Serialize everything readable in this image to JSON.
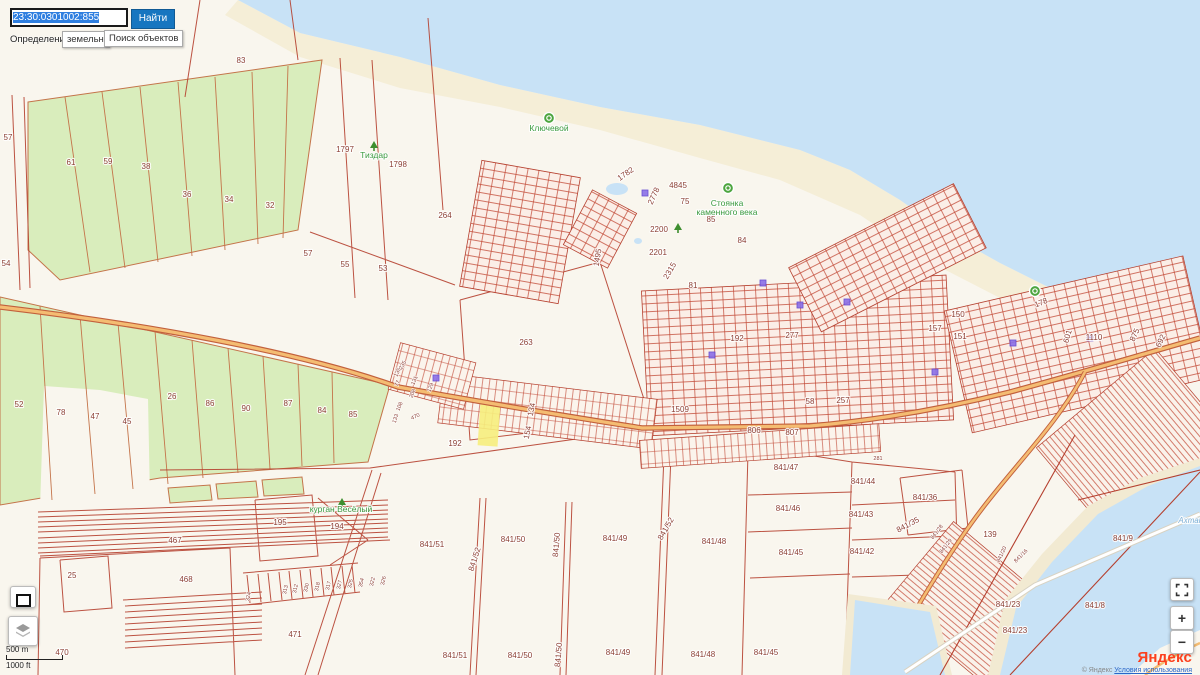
{
  "search": {
    "value": "23:30:0301002:855",
    "find_button": "Найти",
    "definition_label": "Определение:",
    "kind_chip": "земельны",
    "objects_chip": "Поиск объектов"
  },
  "scalebar": {
    "metric": "500 m",
    "imperial": "1000 ft"
  },
  "controls": {
    "zoom_in": "+",
    "zoom_out": "−"
  },
  "attribution": {
    "logo": "Яндекс",
    "copyright": "© Яндекс",
    "terms_link": "Условия использования"
  },
  "colors": {
    "accent_button": "#1676c0",
    "selection": "#2f7fe0",
    "sea": "#c8e2f6",
    "field_green": "#d9edbc",
    "parcel_red": "#c24936",
    "road_orange": "#f4bc72",
    "highlight_parcel": "#f6ee7d",
    "yandex_red": "#fc3f1d"
  },
  "map": {
    "labels": [
      {
        "t": "83",
        "x": 241,
        "y": 63
      },
      {
        "t": "1797",
        "x": 345,
        "y": 152
      },
      {
        "t": "1798",
        "x": 398,
        "y": 167
      },
      {
        "t": "264",
        "x": 445,
        "y": 218
      },
      {
        "t": "263",
        "x": 526,
        "y": 345
      },
      {
        "t": "1495",
        "x": 600,
        "y": 258,
        "r": -80,
        "s": 7
      },
      {
        "t": "55",
        "x": 345,
        "y": 267
      },
      {
        "t": "53",
        "x": 383,
        "y": 271
      },
      {
        "t": "57",
        "x": 8,
        "y": 140,
        "s": 7
      },
      {
        "t": "54",
        "x": 6,
        "y": 266,
        "s": 7
      },
      {
        "t": "61",
        "x": 71,
        "y": 165
      },
      {
        "t": "59",
        "x": 108,
        "y": 164
      },
      {
        "t": "38",
        "x": 146,
        "y": 169
      },
      {
        "t": "36",
        "x": 187,
        "y": 197
      },
      {
        "t": "34",
        "x": 229,
        "y": 202
      },
      {
        "t": "32",
        "x": 270,
        "y": 208
      },
      {
        "t": "57",
        "x": 308,
        "y": 256
      },
      {
        "t": "52",
        "x": 19,
        "y": 407
      },
      {
        "t": "78",
        "x": 61,
        "y": 415
      },
      {
        "t": "47",
        "x": 95,
        "y": 419
      },
      {
        "t": "45",
        "x": 127,
        "y": 424
      },
      {
        "t": "26",
        "x": 172,
        "y": 399
      },
      {
        "t": "86",
        "x": 210,
        "y": 406
      },
      {
        "t": "90",
        "x": 246,
        "y": 411
      },
      {
        "t": "87",
        "x": 288,
        "y": 406
      },
      {
        "t": "84",
        "x": 322,
        "y": 413
      },
      {
        "t": "85",
        "x": 353,
        "y": 417
      },
      {
        "t": "1782",
        "x": 627,
        "y": 176,
        "r": -35,
        "s": 7
      },
      {
        "t": "4845",
        "x": 678,
        "y": 188,
        "s": 7
      },
      {
        "t": "75",
        "x": 685,
        "y": 204,
        "s": 6.5
      },
      {
        "t": "2778",
        "x": 656,
        "y": 197,
        "r": -65,
        "s": 6
      },
      {
        "t": "2200",
        "x": 659,
        "y": 232,
        "s": 7
      },
      {
        "t": "2201",
        "x": 658,
        "y": 255,
        "s": 7
      },
      {
        "t": "2315",
        "x": 672,
        "y": 272,
        "r": -60,
        "s": 6
      },
      {
        "t": "81",
        "x": 693,
        "y": 288,
        "s": 6.5
      },
      {
        "t": "84",
        "x": 742,
        "y": 243,
        "s": 7
      },
      {
        "t": "85",
        "x": 711,
        "y": 222,
        "s": 7
      },
      {
        "t": "192",
        "x": 737,
        "y": 341,
        "s": 7
      },
      {
        "t": "277",
        "x": 792,
        "y": 338,
        "s": 7
      },
      {
        "t": "1509",
        "x": 680,
        "y": 412
      },
      {
        "t": "58",
        "x": 810,
        "y": 404,
        "s": 6.5
      },
      {
        "t": "257",
        "x": 843,
        "y": 403,
        "s": 6.5
      },
      {
        "t": "806",
        "x": 754,
        "y": 433,
        "s": 7.5
      },
      {
        "t": "807",
        "x": 792,
        "y": 435,
        "s": 7.5
      },
      {
        "t": "150",
        "x": 958,
        "y": 317,
        "s": 7.5
      },
      {
        "t": "157",
        "x": 935,
        "y": 331,
        "s": 7
      },
      {
        "t": "151",
        "x": 960,
        "y": 339,
        "s": 7.5
      },
      {
        "t": "1110",
        "x": 1094,
        "y": 340,
        "s": 7
      },
      {
        "t": "875",
        "x": 1137,
        "y": 336,
        "r": -65,
        "s": 7
      },
      {
        "t": "692",
        "x": 1163,
        "y": 342,
        "r": -65,
        "s": 6.5
      },
      {
        "t": "601",
        "x": 1070,
        "y": 337,
        "r": -75,
        "s": 6.5
      },
      {
        "t": "178",
        "x": 1042,
        "y": 305,
        "r": -22,
        "s": 6.5
      },
      {
        "t": "134",
        "x": 534,
        "y": 410,
        "r": -78,
        "s": 6
      },
      {
        "t": "154",
        "x": 530,
        "y": 433,
        "r": -78,
        "s": 6
      },
      {
        "t": "192",
        "x": 455,
        "y": 446,
        "s": 7.5
      },
      {
        "t": "235",
        "x": 404,
        "y": 366,
        "r": -60,
        "k": "tiny"
      },
      {
        "t": "135",
        "x": 399,
        "y": 373,
        "r": -65,
        "k": "tiny"
      },
      {
        "t": "77",
        "x": 399,
        "y": 384,
        "r": -68,
        "k": "tiny"
      },
      {
        "t": "131",
        "x": 416,
        "y": 381,
        "r": -68,
        "k": "tiny"
      },
      {
        "t": "208",
        "x": 414,
        "y": 394,
        "r": -68,
        "k": "tiny"
      },
      {
        "t": "129",
        "x": 432,
        "y": 388,
        "r": -68,
        "k": "tiny"
      },
      {
        "t": "108",
        "x": 401,
        "y": 407,
        "r": -68,
        "k": "tiny"
      },
      {
        "t": "133",
        "x": 397,
        "y": 419,
        "r": -72,
        "k": "tiny"
      },
      {
        "t": "470",
        "x": 416,
        "y": 418,
        "r": -25,
        "k": "tiny"
      },
      {
        "t": "195",
        "x": 280,
        "y": 525
      },
      {
        "t": "194",
        "x": 337,
        "y": 529
      },
      {
        "t": "467",
        "x": 175,
        "y": 543,
        "s": 7
      },
      {
        "t": "468",
        "x": 186,
        "y": 582
      },
      {
        "t": "25",
        "x": 72,
        "y": 578
      },
      {
        "t": "471",
        "x": 295,
        "y": 637
      },
      {
        "t": "470",
        "x": 62,
        "y": 655,
        "s": 7
      },
      {
        "t": "324",
        "x": 250,
        "y": 597,
        "r": -78,
        "k": "tiny"
      },
      {
        "t": "313",
        "x": 287,
        "y": 590,
        "r": -78,
        "k": "tiny"
      },
      {
        "t": "312",
        "x": 297,
        "y": 589,
        "r": -78,
        "k": "tiny"
      },
      {
        "t": "330",
        "x": 308,
        "y": 588,
        "r": -78,
        "k": "tiny"
      },
      {
        "t": "318",
        "x": 319,
        "y": 587,
        "r": -78,
        "k": "tiny"
      },
      {
        "t": "317",
        "x": 330,
        "y": 586,
        "r": -78,
        "k": "tiny"
      },
      {
        "t": "327",
        "x": 341,
        "y": 585,
        "r": -78,
        "k": "tiny"
      },
      {
        "t": "325",
        "x": 352,
        "y": 584,
        "r": -78,
        "k": "tiny"
      },
      {
        "t": "354",
        "x": 363,
        "y": 583,
        "r": -78,
        "k": "tiny"
      },
      {
        "t": "322",
        "x": 374,
        "y": 582,
        "r": -78,
        "k": "tiny"
      },
      {
        "t": "326",
        "x": 385,
        "y": 581,
        "r": -78,
        "k": "tiny"
      },
      {
        "t": "841/51",
        "x": 432,
        "y": 547,
        "s": 7.5
      },
      {
        "t": "841/50",
        "x": 513,
        "y": 542,
        "s": 7.5
      },
      {
        "t": "841/49",
        "x": 615,
        "y": 541,
        "s": 7.5
      },
      {
        "t": "841/52",
        "x": 477,
        "y": 560,
        "r": -72,
        "s": 6.5
      },
      {
        "t": "841/50",
        "x": 559,
        "y": 545,
        "r": -85,
        "s": 6.5
      },
      {
        "t": "841/52",
        "x": 668,
        "y": 530,
        "r": -60,
        "s": 6.5
      },
      {
        "t": "841/47",
        "x": 786,
        "y": 470,
        "s": 7.5
      },
      {
        "t": "841/44",
        "x": 863,
        "y": 484,
        "s": 7.5
      },
      {
        "t": "841/46",
        "x": 788,
        "y": 511,
        "s": 7.5
      },
      {
        "t": "841/43",
        "x": 861,
        "y": 517,
        "s": 7.5
      },
      {
        "t": "841/48",
        "x": 714,
        "y": 544,
        "s": 7.5
      },
      {
        "t": "841/45",
        "x": 791,
        "y": 555,
        "s": 7.5
      },
      {
        "t": "841/42",
        "x": 862,
        "y": 554,
        "s": 7.5
      },
      {
        "t": "841/36",
        "x": 925,
        "y": 500,
        "s": 7
      },
      {
        "t": "841/35",
        "x": 909,
        "y": 527,
        "r": -28,
        "s": 6
      },
      {
        "t": "841/28",
        "x": 938,
        "y": 533,
        "r": -52,
        "k": "tiny"
      },
      {
        "t": "841/29",
        "x": 947,
        "y": 547,
        "r": -52,
        "k": "tiny"
      },
      {
        "t": "281",
        "x": 878,
        "y": 460,
        "k": "tiny"
      },
      {
        "t": "841/51",
        "x": 455,
        "y": 658,
        "s": 7.5
      },
      {
        "t": "841/50",
        "x": 520,
        "y": 658,
        "s": 7.5
      },
      {
        "t": "841/50",
        "x": 561,
        "y": 655,
        "r": -85,
        "s": 6.5
      },
      {
        "t": "841/49",
        "x": 618,
        "y": 655,
        "s": 7.5
      },
      {
        "t": "841/48",
        "x": 703,
        "y": 657,
        "s": 7.5
      },
      {
        "t": "841/45",
        "x": 766,
        "y": 655,
        "s": 7.5
      },
      {
        "t": "841/9",
        "x": 1123,
        "y": 541,
        "s": 7.5
      },
      {
        "t": "841/8",
        "x": 1095,
        "y": 608,
        "s": 7.5
      },
      {
        "t": "841/23",
        "x": 1008,
        "y": 607,
        "s": 6
      },
      {
        "t": "841/23",
        "x": 1015,
        "y": 633,
        "s": 6
      },
      {
        "t": "841/16",
        "x": 1022,
        "y": 557,
        "r": -45,
        "k": "tiny"
      },
      {
        "t": "841/20",
        "x": 1003,
        "y": 555,
        "r": -65,
        "k": "tiny"
      },
      {
        "t": "139",
        "x": 990,
        "y": 537,
        "s": 6
      },
      {
        "t": "Тиздар",
        "x": 374,
        "y": 158,
        "k": "green"
      },
      {
        "t": "Ключевой",
        "x": 549,
        "y": 131,
        "k": "green"
      },
      {
        "t": "Стоянка",
        "x": 727,
        "y": 206,
        "k": "green",
        "s": 7.5
      },
      {
        "t": "каменного века",
        "x": 727,
        "y": 215,
        "k": "green",
        "s": 7.5
      },
      {
        "t": "курган Весёлый",
        "x": 341,
        "y": 512,
        "k": "green",
        "s": 7.5
      },
      {
        "t": "Ахтани",
        "x": 1193,
        "y": 523,
        "k": "water"
      }
    ],
    "pois": [
      {
        "x": 549,
        "y": 118,
        "kind": "poi-circle"
      },
      {
        "x": 728,
        "y": 188,
        "kind": "poi-circle"
      },
      {
        "x": 1035,
        "y": 291,
        "kind": "poi-circle"
      },
      {
        "x": 374,
        "y": 146,
        "kind": "tree"
      },
      {
        "x": 342,
        "y": 503,
        "kind": "tree"
      },
      {
        "x": 678,
        "y": 228,
        "kind": "tree"
      }
    ],
    "markers": [
      {
        "x": 645,
        "y": 193
      },
      {
        "x": 763,
        "y": 283
      },
      {
        "x": 800,
        "y": 305
      },
      {
        "x": 847,
        "y": 302
      },
      {
        "x": 935,
        "y": 372
      },
      {
        "x": 1013,
        "y": 343
      },
      {
        "x": 1090,
        "y": 338
      },
      {
        "x": 436,
        "y": 378
      },
      {
        "x": 712,
        "y": 355
      }
    ]
  }
}
